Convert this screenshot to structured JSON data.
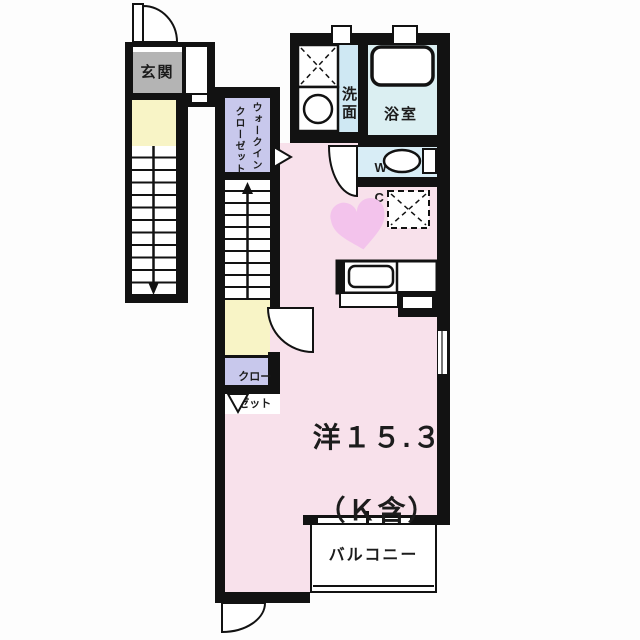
{
  "labels": {
    "entrance": "玄関",
    "wic_line1": "ウォークイン",
    "wic_line2": "クローゼット",
    "washroom": "洗面",
    "bathroom": "浴室",
    "wc_line1": "W",
    "wc_line2": "C",
    "closet_line1": "クロー",
    "closet_line2": "ゼット",
    "room_line1": "洋１５.３",
    "room_line2": "（Ｋ含）",
    "balcony": "バルコニー"
  },
  "colors": {
    "wall": "#121212",
    "room-pink": "#f8e1eb",
    "lavender": "#c8c8ec",
    "yellow": "#f8f4c6",
    "gray": "#b4b4b4",
    "washroom-blue": "#cfe8f3",
    "bathroom-cyan": "#dbeff2",
    "wc-blue": "#d8edf6",
    "heart-pink": "#f3c3ec",
    "text": "#1c1c1c"
  }
}
